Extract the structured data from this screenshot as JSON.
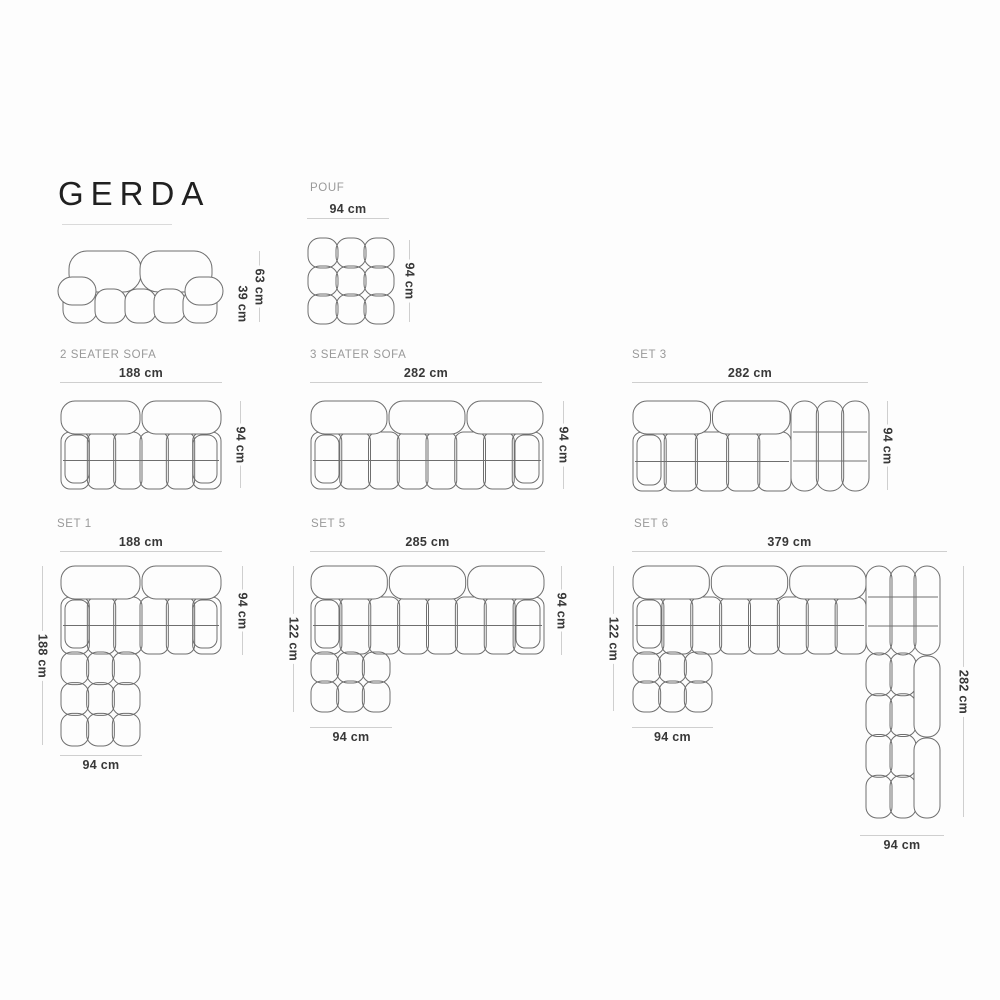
{
  "title": "GERDA",
  "colors": {
    "background": "#fdfdfd",
    "title": "#202020",
    "section_label": "#999999",
    "dimension_text": "#383838",
    "dimension_line": "#cfcfcf",
    "drawing_stroke": "#6e6e6e"
  },
  "diagrams": {
    "pouf": {
      "label": "POUF",
      "width": "94 cm",
      "depth": "94 cm"
    },
    "front_view": {
      "total_height": "63 cm",
      "seat_height": "39 cm"
    },
    "two_seater": {
      "label": "2 SEATER SOFA",
      "width": "188 cm",
      "depth": "94 cm"
    },
    "three_seater": {
      "label": "3 SEATER SOFA",
      "width": "282 cm",
      "depth": "94 cm"
    },
    "set3": {
      "label": "SET 3",
      "width": "282 cm",
      "depth": "94 cm"
    },
    "set1": {
      "label": "SET 1",
      "width": "188 cm",
      "total_depth": "188 cm",
      "depth": "94 cm",
      "chaise_width": "94 cm"
    },
    "set5": {
      "label": "SET 5",
      "width": "285 cm",
      "total_depth": "122 cm",
      "depth": "94 cm",
      "chaise_width": "94 cm"
    },
    "set6": {
      "label": "SET 6",
      "width": "379 cm",
      "left_depth": "122 cm",
      "right_depth": "282 cm",
      "chaise_width": "94 cm",
      "right_width": "94 cm"
    }
  }
}
